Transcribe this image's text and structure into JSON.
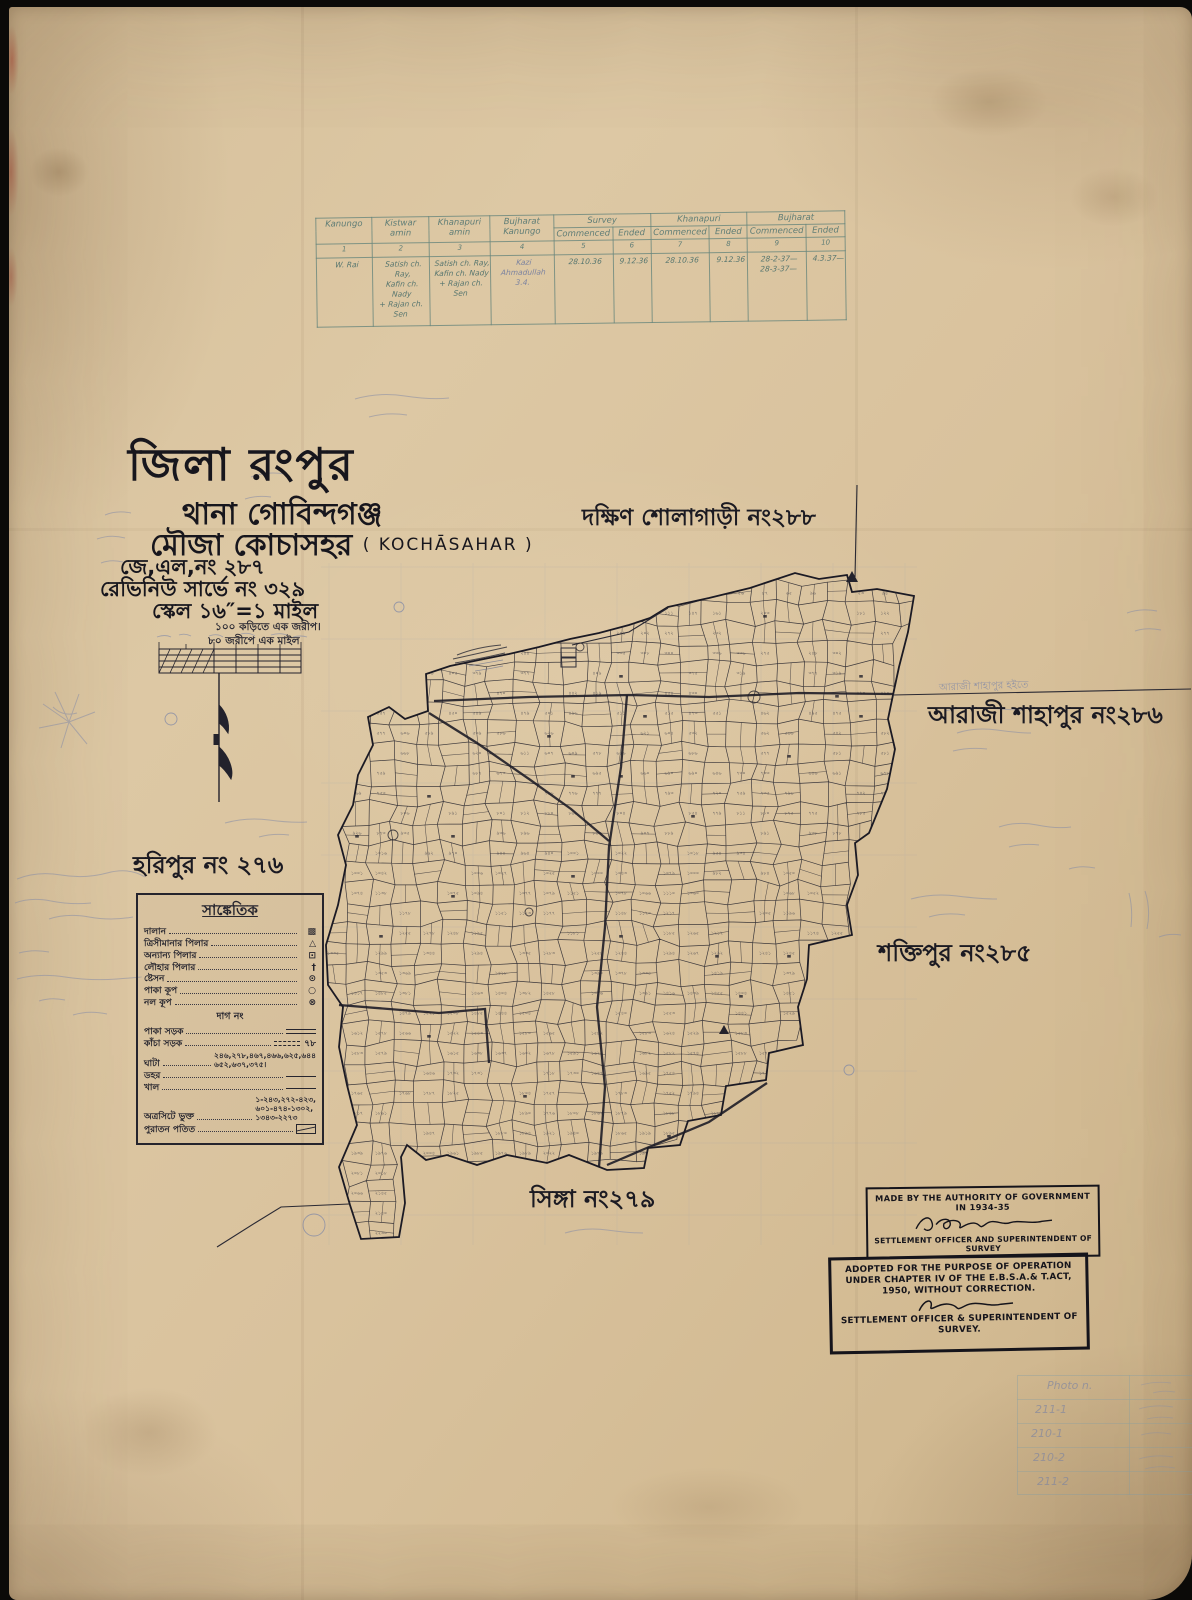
{
  "title_block": {
    "district": "জিলা রংপুর",
    "thana": "থানা গোবিন্দগঞ্জ",
    "mouza": "মৌজা কোচাসহর",
    "mouza_latin": "( KOCHĀSAHAR )",
    "jl_no": "জে,এল,নং ২৮৭",
    "revenue_survey_no": "রেভিনিউ সার্ভে নং ৩২৯",
    "scale": "স্কেল ১৬″=১ মাইল",
    "scale_note1": "১০০ কড়িতে এক জরীপ।",
    "scale_note2": "৮০ জরীপে এক মাইল"
  },
  "survey_table": {
    "columns": [
      "Kanungo",
      "Kistwar amin",
      "Khanapuri amin",
      "Bujharat Kanungo"
    ],
    "groups": [
      "Survey",
      "Khanapuri",
      "Bujharat"
    ],
    "sub": [
      "Commenced",
      "Ended"
    ],
    "col_numbers": [
      "1",
      "2",
      "3",
      "4",
      "5",
      "6",
      "7",
      "8",
      "9",
      "10"
    ],
    "row": {
      "kanungo": "W. Rai",
      "kistwar_amin": "Satish ch. Ray,\nKafin ch. Nady\n+ Rajan ch. Sen",
      "khanapuri_amin": "Satish ch. Ray,\nKafin ch. Nady\n+ Rajan ch. Sen",
      "bujharat_kanungo": "Kazi Ahmadullah\n3.4.",
      "survey_commenced": "28.10.36",
      "survey_ended": "9.12.36",
      "khanapuri_commenced": "28.10.36",
      "khanapuri_ended": "9.12.36",
      "bujharat_commenced": "28-2-37—\n28-3-37—",
      "bujharat_ended": "4.3.37—"
    }
  },
  "neighbours": {
    "north": "দক্ষিণ শোলাগাড়ী নং২৮৮",
    "east": "আরাজী শাহাপুর নং২৮৬",
    "southeast": "শক্তিপুর নং২৮৫",
    "west": "হরিপুর নং ২৭৬",
    "south": "সিঙ্গা নং২৭৯"
  },
  "annotations": {
    "araji_note": "আরাজী শাহাপুর হইতে"
  },
  "legend": {
    "title": "সাঙ্কেতিক",
    "subtitle": "দাগ নং",
    "rows": [
      {
        "label": "দালান",
        "symbol": "▩"
      },
      {
        "label": "ত্রিসীমানার পিলার",
        "symbol": "△"
      },
      {
        "label": "অন্যান্য পিলার",
        "symbol": "⊡"
      },
      {
        "label": "লৌহার পিলার",
        "symbol": "†"
      },
      {
        "label": "ষ্টেসন",
        "symbol": "⊙"
      },
      {
        "label": "পাকা কূপ",
        "symbol": "○"
      },
      {
        "label": "নল কূপ",
        "symbol": "⊗"
      },
      {
        "label": "পাকা সড়ক",
        "symbol": ""
      },
      {
        "label": "কাঁচা সড়ক",
        "symbol": "৭৮"
      },
      {
        "label": "ঘাটা",
        "value": "২৪৬,২৭৮,৪৬৭,৪৬৬,৬২৫,৬৪৪\n৬৫২,৬৩৭,৩৭৫।"
      },
      {
        "label": "ডহর",
        "symbol": ""
      },
      {
        "label": "খাল",
        "symbol": ""
      },
      {
        "label": "অত্রসিটে ভুক্ত",
        "value": "১-২৪৩,২৭২-৪২৩,\n৬০১-৪৭৪-১৩০২,\n১৩৪৩-২২৭৩"
      },
      {
        "label": "পুরাতন পতিত",
        "symbol": ""
      }
    ]
  },
  "stamps": {
    "made": {
      "line1": "MADE BY THE AUTHORITY OF GOVERNMENT IN 1934-35",
      "line2": "SETTLEMENT OFFICER AND SUPERINTENDENT OF SURVEY"
    },
    "adopted": {
      "line1": "ADOPTED FOR THE PURPOSE OF OPERATION",
      "line2": "UNDER CHAPTER IV OF THE E.B.S.A.& T.ACT,",
      "line3": "1950, WITHOUT CORRECTION.",
      "line4": "SETTLEMENT OFFICER & SUPERINTENDENT OF",
      "line5": "SURVEY."
    }
  },
  "photo_table": {
    "header": "Photo n.",
    "rows": [
      "211-1",
      "210-1",
      "210-2",
      "211-2"
    ]
  },
  "map": {
    "ink": "#23222c",
    "pencil": "#868ca6",
    "bbox": [
      312,
      556,
      908,
      1238
    ],
    "cell_w": 24,
    "cell_h": 20,
    "seed": 20287,
    "label_rate": 0.55,
    "digits": "০১২৩৪৫৬৭৮৯",
    "max_plot": 2273,
    "boundary": [
      [
        659,
        600
      ],
      [
        700,
        591
      ],
      [
        741,
        581
      ],
      [
        786,
        566
      ],
      [
        810,
        572
      ],
      [
        838,
        568
      ],
      [
        843,
        585
      ],
      [
        868,
        582
      ],
      [
        905,
        589
      ],
      [
        899,
        625
      ],
      [
        890,
        660
      ],
      [
        884,
        688
      ],
      [
        879,
        712
      ],
      [
        886,
        742
      ],
      [
        878,
        782
      ],
      [
        860,
        826
      ],
      [
        846,
        836
      ],
      [
        849,
        868
      ],
      [
        838,
        898
      ],
      [
        843,
        928
      ],
      [
        800,
        938
      ],
      [
        798,
        972
      ],
      [
        789,
        1000
      ],
      [
        794,
        1038
      ],
      [
        760,
        1046
      ],
      [
        757,
        1073
      ],
      [
        717,
        1079
      ],
      [
        712,
        1108
      ],
      [
        679,
        1114
      ],
      [
        671,
        1138
      ],
      [
        639,
        1141
      ],
      [
        635,
        1161
      ],
      [
        598,
        1163
      ],
      [
        560,
        1148
      ],
      [
        538,
        1156
      ],
      [
        498,
        1148
      ],
      [
        468,
        1158
      ],
      [
        438,
        1148
      ],
      [
        417,
        1153
      ],
      [
        398,
        1138
      ],
      [
        392,
        1150
      ],
      [
        396,
        1196
      ],
      [
        390,
        1230
      ],
      [
        352,
        1232
      ],
      [
        341,
        1198
      ],
      [
        330,
        1160
      ],
      [
        348,
        1118
      ],
      [
        338,
        1078
      ],
      [
        330,
        1040
      ],
      [
        334,
        1000
      ],
      [
        319,
        978
      ],
      [
        317,
        938
      ],
      [
        329,
        898
      ],
      [
        337,
        858
      ],
      [
        329,
        828
      ],
      [
        344,
        798
      ],
      [
        349,
        768
      ],
      [
        364,
        738
      ],
      [
        359,
        710
      ],
      [
        380,
        700
      ],
      [
        396,
        712
      ],
      [
        419,
        704
      ],
      [
        417,
        667
      ],
      [
        441,
        659
      ],
      [
        470,
        653
      ],
      [
        500,
        647
      ],
      [
        530,
        640
      ],
      [
        561,
        632
      ],
      [
        590,
        626
      ],
      [
        620,
        618
      ],
      [
        641,
        611
      ]
    ],
    "roads": [
      [
        [
          425,
          694
        ],
        [
          520,
          690
        ],
        [
          620,
          688
        ],
        [
          700,
          690
        ],
        [
          790,
          686
        ],
        [
          884,
          687
        ]
      ],
      [
        [
          618,
          688
        ],
        [
          612,
          760
        ],
        [
          600,
          840
        ],
        [
          596,
          920
        ],
        [
          588,
          1000
        ],
        [
          596,
          1080
        ],
        [
          590,
          1160
        ]
      ],
      [
        [
          330,
          998
        ],
        [
          430,
          1006
        ],
        [
          476,
          1002
        ],
        [
          480,
          1056
        ]
      ],
      [
        [
          420,
          706
        ],
        [
          468,
          736
        ],
        [
          520,
          772
        ],
        [
          562,
          802
        ],
        [
          600,
          834
        ]
      ],
      [
        [
          598,
          1158
        ],
        [
          640,
          1140
        ],
        [
          700,
          1115
        ],
        [
          758,
          1076
        ]
      ]
    ],
    "ext_lines": [
      [
        [
          848,
          478
        ],
        [
          846,
          570
        ]
      ],
      [
        [
          884,
          688
        ],
        [
          1182,
          682
        ]
      ],
      [
        [
          340,
          1197
        ],
        [
          272,
          1200
        ],
        [
          246,
          1216
        ],
        [
          208,
          1240
        ]
      ],
      [
        [
          563,
          638
        ],
        [
          620,
          625
        ],
        [
          659,
          601
        ]
      ]
    ],
    "ponds": [
      [
        390,
        600,
        5
      ],
      [
        162,
        712,
        6
      ],
      [
        384,
        828,
        5
      ],
      [
        745,
        690,
        6
      ],
      [
        520,
        905,
        4
      ],
      [
        840,
        1063,
        5
      ],
      [
        571,
        640,
        4
      ],
      [
        305,
        1218,
        11
      ]
    ]
  }
}
